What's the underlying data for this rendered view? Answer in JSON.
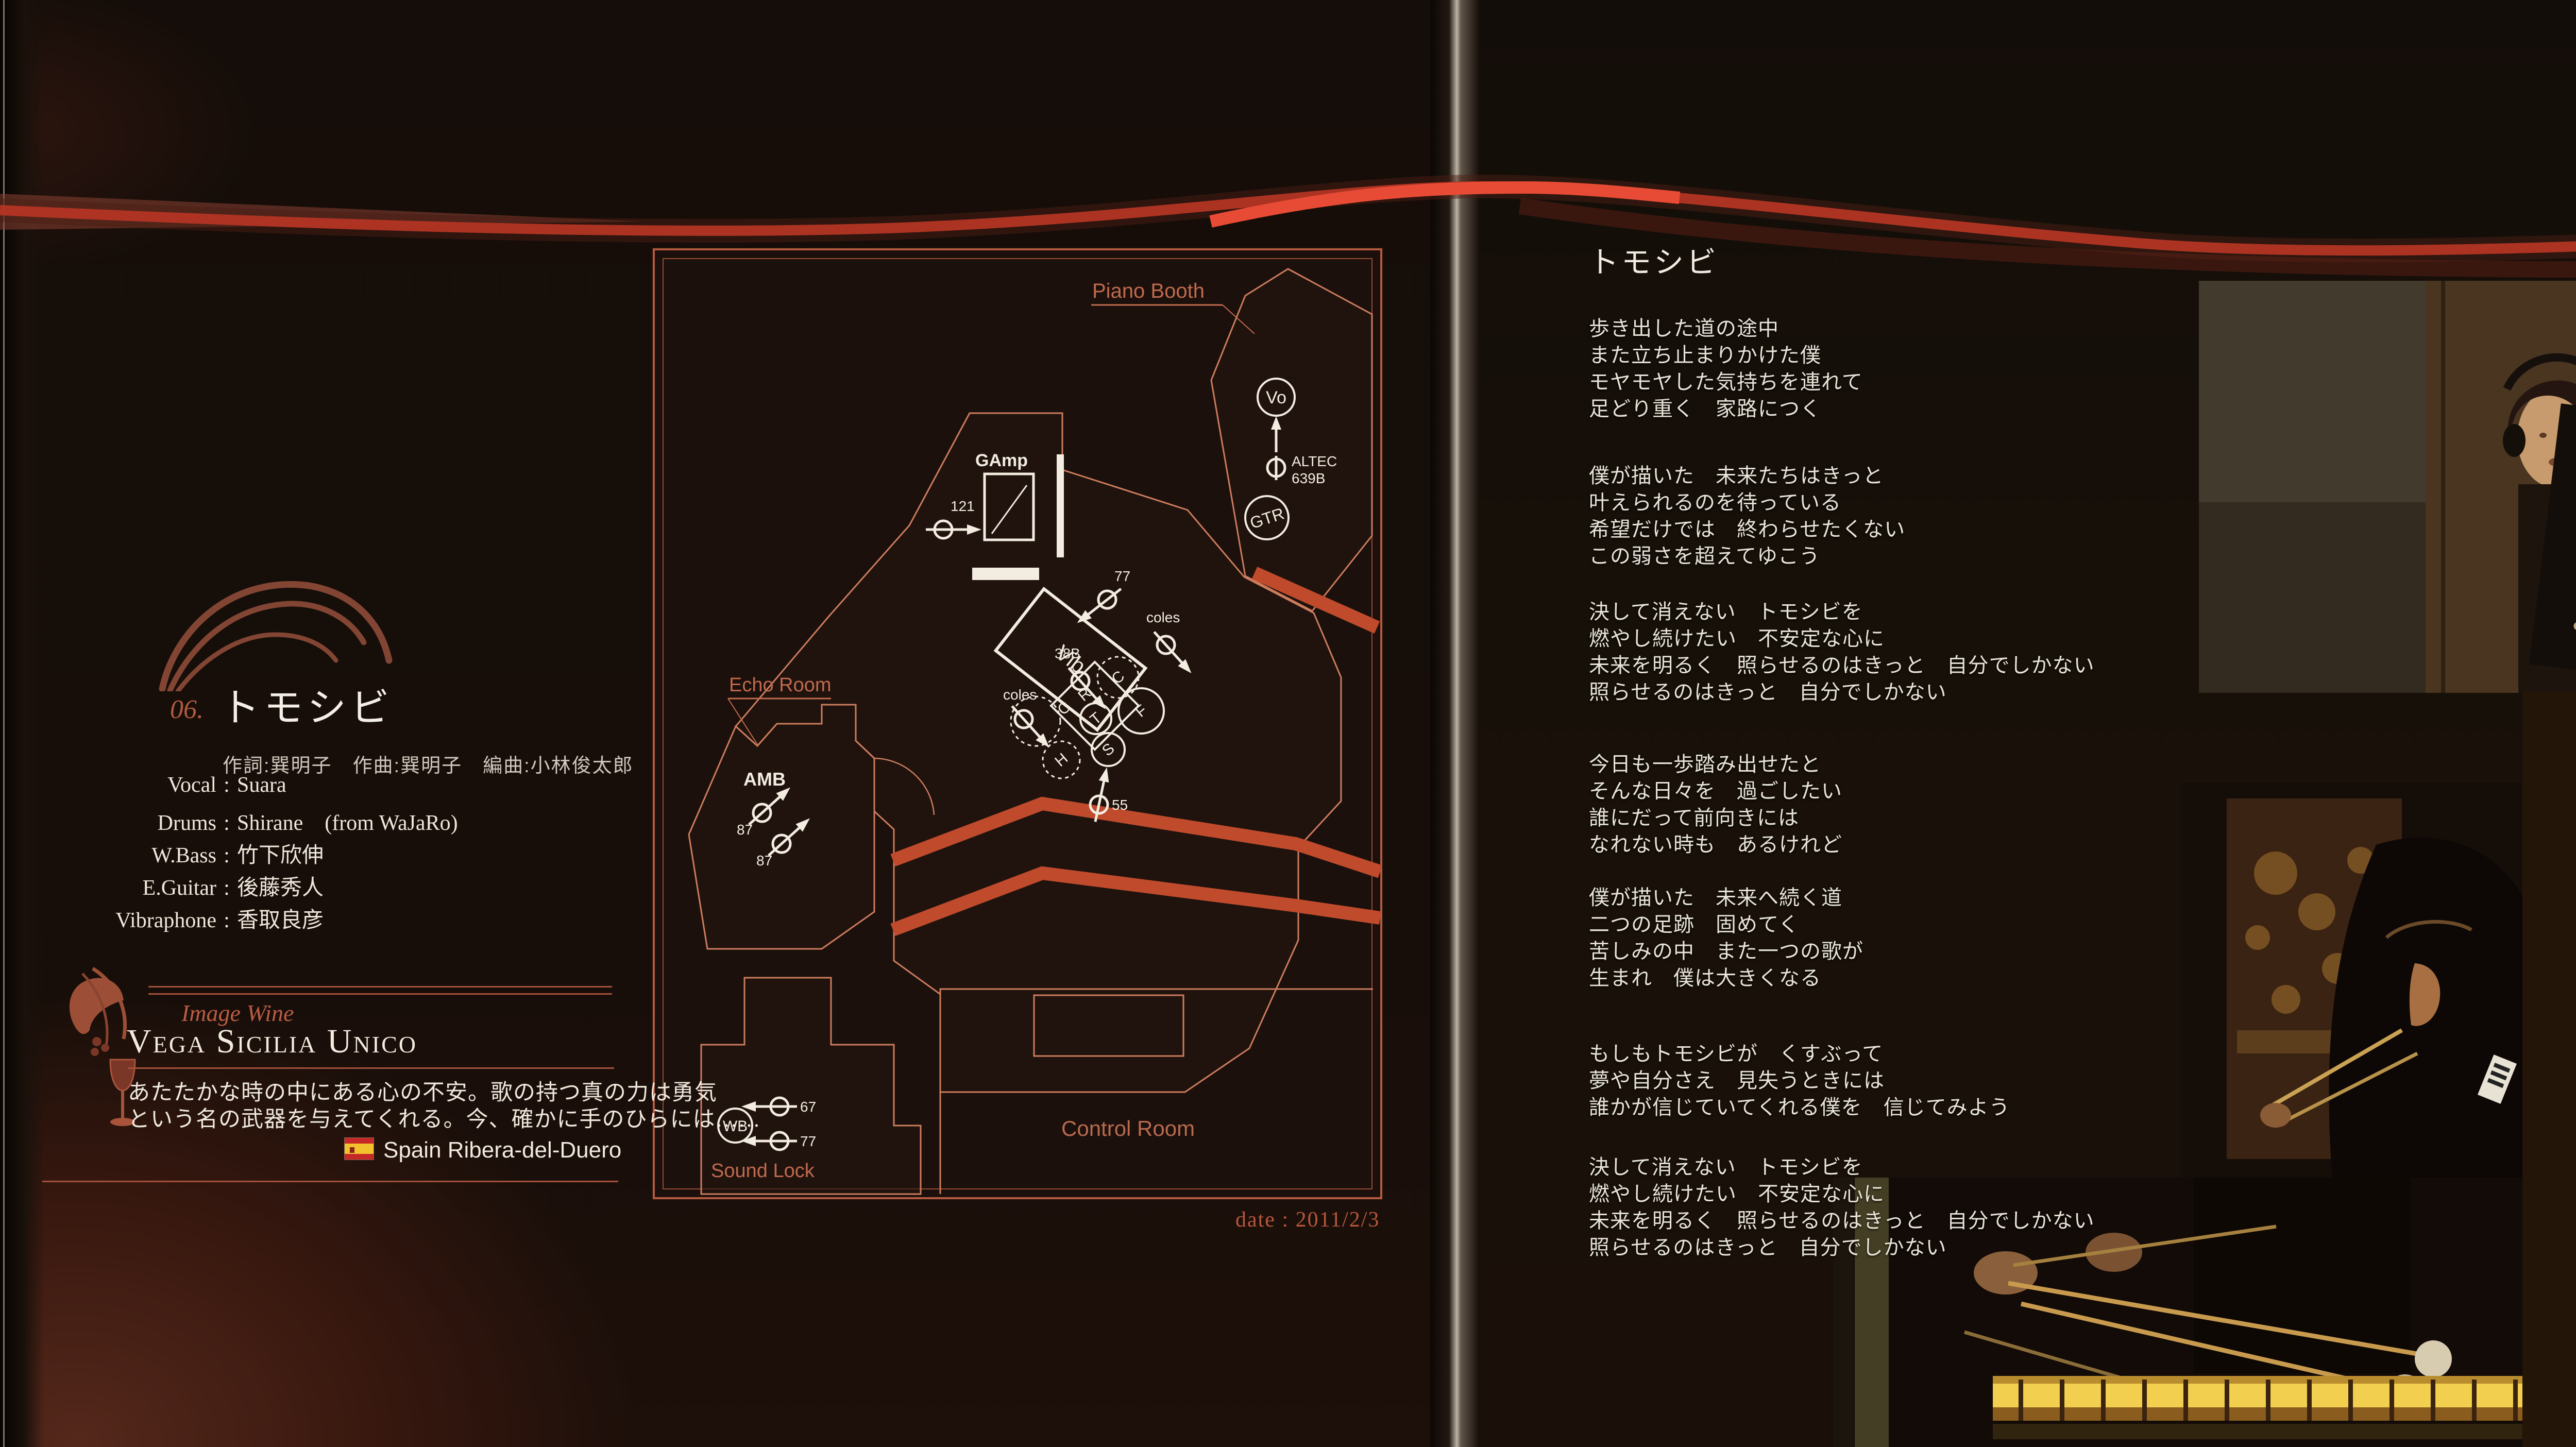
{
  "colors": {
    "accent_red": "#c0392a",
    "bright_red": "#e84b35",
    "plan_line": "#cd7c5e",
    "plan_label": "#c06a4e",
    "white": "#f2ece1",
    "page_bg": "#150d09"
  },
  "left_page": {
    "track": {
      "number": "06.",
      "title": "トモシビ",
      "credits": "作詞:巽明子　作曲:巽明子　編曲:小林俊太郎"
    },
    "musicians": [
      {
        "role": "Vocal",
        "name": "Suara"
      },
      {
        "role": "Drums",
        "name": "Shirane　(from WaJaRo)"
      },
      {
        "role": "W.Bass",
        "name": "竹下欣伸"
      },
      {
        "role": "E.Guitar",
        "name": "後藤秀人"
      },
      {
        "role": "Vibraphone",
        "name": "香取良彦"
      }
    ],
    "wine": {
      "section_label": "Image Wine",
      "name": "Vega Sicilia Unico",
      "description_line1": "あたたかな時の中にある心の不安。歌の持つ真の力は勇気",
      "description_line2": "という名の武器を与えてくれる。今、確かに手のひらには……",
      "origin": "Spain Ribera-del-Duero"
    },
    "floor_plan": {
      "rooms": {
        "piano_booth": "Piano Booth",
        "echo_room": "Echo Room",
        "sound_lock": "Sound Lock",
        "control_room": "Control Room"
      },
      "labels": {
        "gamp": "GAmp",
        "amb": "AMB",
        "vo": "Vo",
        "gtr": "GTR",
        "vib": "Vib",
        "wb": "WB",
        "altec_1": "ALTEC",
        "altec_2": "639B",
        "mic_121": "121",
        "mic_77_vib": "77",
        "coles_a": "coles",
        "mic_38b": "38B",
        "coles_b": "coles",
        "mic_55": "55",
        "mic_87_a": "87",
        "mic_87_b": "87",
        "mic_67": "67",
        "mic_77_wb": "77"
      },
      "drum_letters": [
        "R",
        "C",
        "F",
        "T",
        "S",
        "H",
        "C"
      ],
      "date": "date : 2011/2/3"
    }
  },
  "right_page": {
    "lyrics_title": "トモシビ",
    "stanzas": [
      {
        "lines": [
          "歩き出した道の途中",
          "また立ち止まりかけた僕",
          "モヤモヤした気持ちを連れて",
          "足どり重く　家路につく"
        ]
      },
      {
        "lines": [
          "僕が描いた　未来たちはきっと",
          "叶えられるのを待っている",
          "希望だけでは　終わらせたくない",
          "この弱さを超えてゆこう"
        ]
      },
      {
        "lines": [
          "決して消えない　トモシビを",
          "燃やし続けたい　不安定な心に",
          "未来を明るく　照らせるのはきっと　自分でしかない",
          "照らせるのはきっと　自分でしかない"
        ]
      },
      {
        "lines": [
          "今日も一歩踏み出せたと",
          "そんな日々を　過ごしたい",
          "誰にだって前向きには",
          "なれない時も　あるけれど"
        ]
      },
      {
        "lines": [
          "僕が描いた　未来へ続く道",
          "二つの足跡　固めてく",
          "苦しみの中　また一つの歌が",
          "生まれ　僕は大きくなる"
        ]
      },
      {
        "lines": [
          "もしもトモシビが　くすぶって",
          "夢や自分さえ　見失うときには",
          "誰かが信じていてくれる僕を　信じてみよう"
        ]
      },
      {
        "lines": [
          "決して消えない　トモシビを",
          "燃やし続けたい　不安定な心に",
          "未来を明るく　照らせるのはきっと　自分でしかない",
          "照らせるのはきっと　自分でしかない"
        ]
      }
    ]
  }
}
